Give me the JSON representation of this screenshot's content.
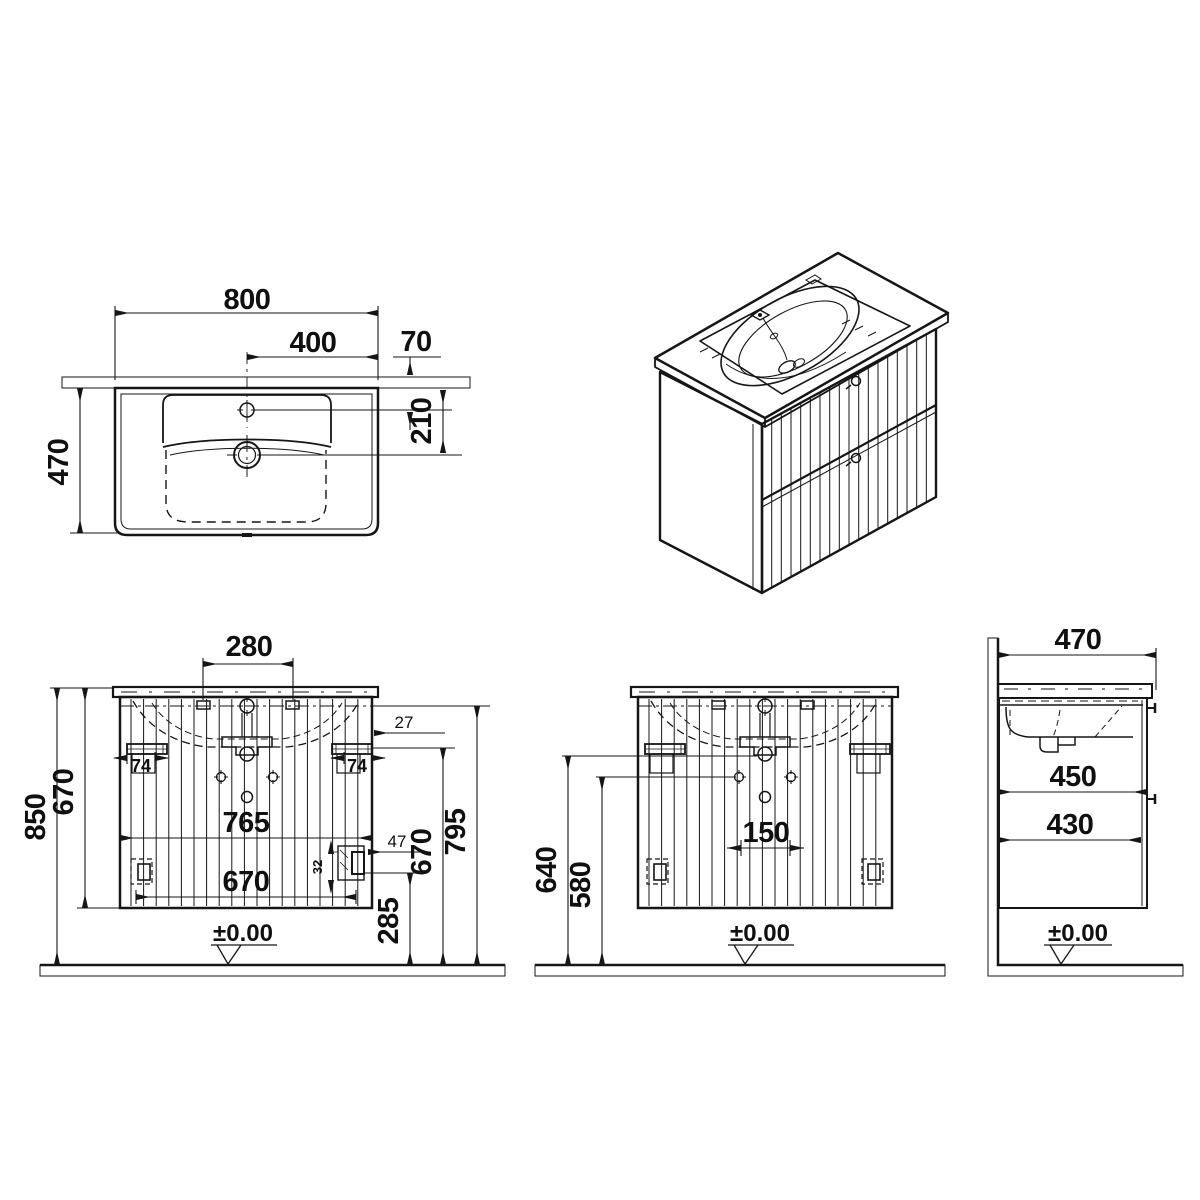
{
  "plan": {
    "width": "800",
    "half_width": "400",
    "wall_offset": "70",
    "depth": "470",
    "drain_offset": "210"
  },
  "front_a": {
    "slot_spacing": "280",
    "overall_height": "850",
    "cabinet_height": "670",
    "body_width": "765",
    "front_width": "670",
    "bracket_left": "74",
    "bracket_right": "74",
    "side_offset": "27",
    "slide_offset": "47",
    "slide_height": "32",
    "rail_height": "670",
    "carcass_height": "795",
    "clearance_height": "285",
    "datum": "±0.00"
  },
  "front_b": {
    "drain_height": "640",
    "fixing_height": "580",
    "siphon_width": "150",
    "datum": "±0.00"
  },
  "side": {
    "depth": "470",
    "top_depth": "450",
    "drawer_depth": "430",
    "datum": "±0.00"
  }
}
